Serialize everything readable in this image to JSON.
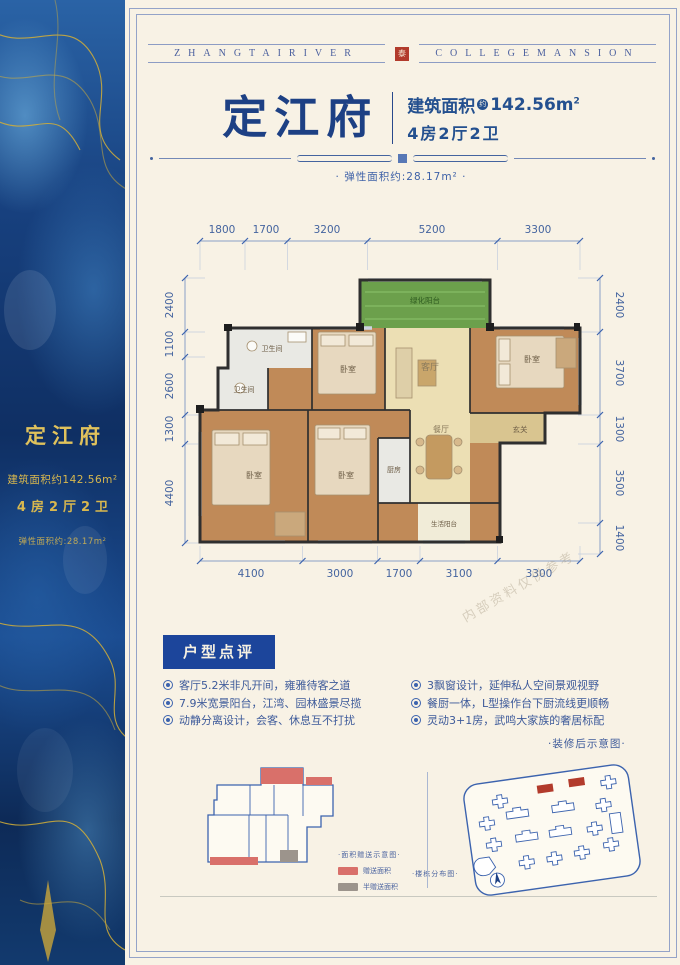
{
  "banner": {
    "left": "ZHANGTAIRIVER",
    "seal": "泰",
    "right": "COLLEGEMANSION"
  },
  "sidebar": {
    "title": "定江府",
    "area": "建筑面积约142.56m²",
    "layout": "4房2厅2卫",
    "flex": "弹性面积约:28.17m²"
  },
  "title_block": {
    "name": "定江府",
    "area_label": "建筑面积",
    "approx": "约",
    "area_value": "142.56m",
    "area_sup": "2",
    "layout": "4房2厅2卫",
    "flex_note": "· 弹性面积约:28.17m² ·"
  },
  "floorplan": {
    "dims_top": [
      "1800",
      "1700",
      "3200",
      "5200",
      "3300"
    ],
    "dims_bottom": [
      "4100",
      "3000",
      "1700",
      "3100",
      "3300"
    ],
    "dims_left": [
      "2400",
      "1100",
      "2600",
      "1300",
      "4400"
    ],
    "dims_right": [
      "2400",
      "3700",
      "1300",
      "3500",
      "1400"
    ],
    "rooms": {
      "green_balcony": "绿化阳台",
      "bath1": "卫生间",
      "bath2": "卫生间",
      "bed_top_mid": "卧室",
      "living": "客厅",
      "bed_top_right": "卧室",
      "entry": "玄关",
      "dining": "餐厅",
      "kitchen": "厨房",
      "bed_master": "卧室",
      "bed_bottom_mid": "卧室",
      "utility_balcony": "生活阳台"
    }
  },
  "review": {
    "title": "户型点评",
    "bullets_left": [
      "客厅5.2米非凡开间，雍雅待客之道",
      "7.9米宽景阳台，江湾、园林盛景尽揽",
      "动静分离设计，会客、休息互不打扰"
    ],
    "bullets_right": [
      "3飘窗设计，延伸私人空间景观视野",
      "餐厨一体，L型操作台下厨流线更顺畅",
      "灵动3+1房，武鸣大家族的奢居标配"
    ],
    "note": "·装修后示意图·"
  },
  "panels": {
    "legend_title": "·面积赠送示意图·",
    "legend": [
      {
        "label": "赠送面积",
        "color": "#d9706a"
      },
      {
        "label": "半赠送面积",
        "color": "#9c948c"
      }
    ],
    "site_caption": "·楼栋分布图·"
  },
  "watermark": "内部资料仅供参考",
  "colors": {
    "accent_navy": "#1d4084",
    "seal_red": "#b23b2c",
    "gold": "#d9b84e",
    "review_bg": "#1c459b",
    "plan_wood": "#c08a58",
    "plan_tile": "#ecdfb4",
    "plan_green": "#6ca04c"
  }
}
